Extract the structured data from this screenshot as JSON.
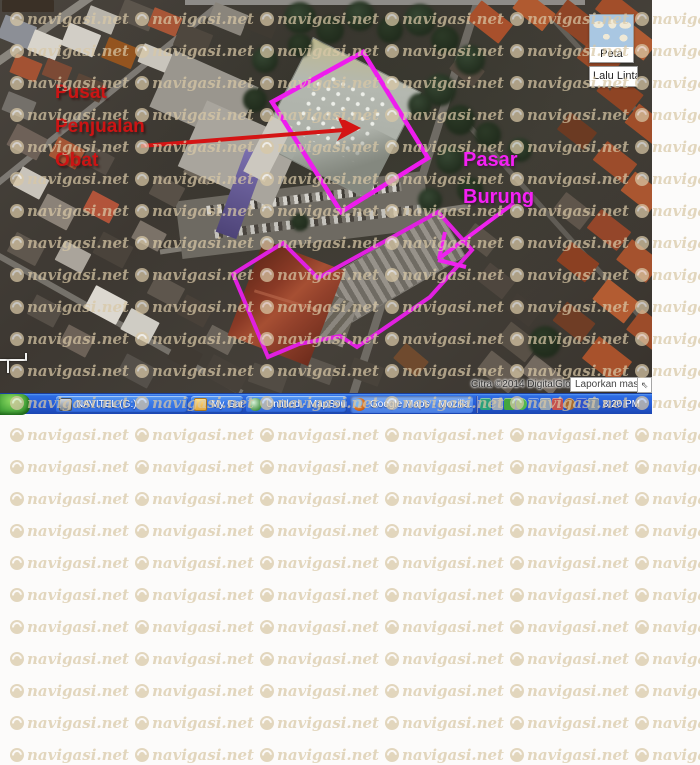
{
  "watermark": {
    "text": "navigasi.net",
    "color": "#d9c8a6"
  },
  "map": {
    "annotations": {
      "pusat_penjualan_obat": {
        "lines": [
          "Pusat",
          "Penjualan",
          "Obat"
        ],
        "color": "#cc1414"
      },
      "pasar_burung": {
        "lines": [
          "Pasar",
          "Burung"
        ],
        "color": "#f520f5"
      }
    },
    "outline_color": "#e020e0",
    "controls": {
      "map_type_button": "Peta",
      "traffic_button": "Lalu Linta",
      "chevron": "▼"
    },
    "attribution": {
      "imagery_credit": "Citra ©2014 DigitalGlobe -",
      "report_link": "Laporkan masalah",
      "shortcut_glyph": "⇖"
    }
  },
  "taskbar": {
    "buttons": [
      {
        "label": "NAVITEL (G:)",
        "active": false
      },
      {
        "label": "My Garmin",
        "active": false
      },
      {
        "label": "Untitled - MapSource",
        "active": false
      },
      {
        "label": "Google Maps - Mozilla...",
        "active": true
      }
    ],
    "clock": "8:20 PM",
    "tray_icon_colors": [
      "#2aa07c",
      "#9aa7b8",
      "#44a63e",
      "#52b84e",
      "#3b6fd6",
      "#93a3b4",
      "#c4504e",
      "#a86a30",
      "#2b50cc",
      "#8494a6"
    ]
  }
}
